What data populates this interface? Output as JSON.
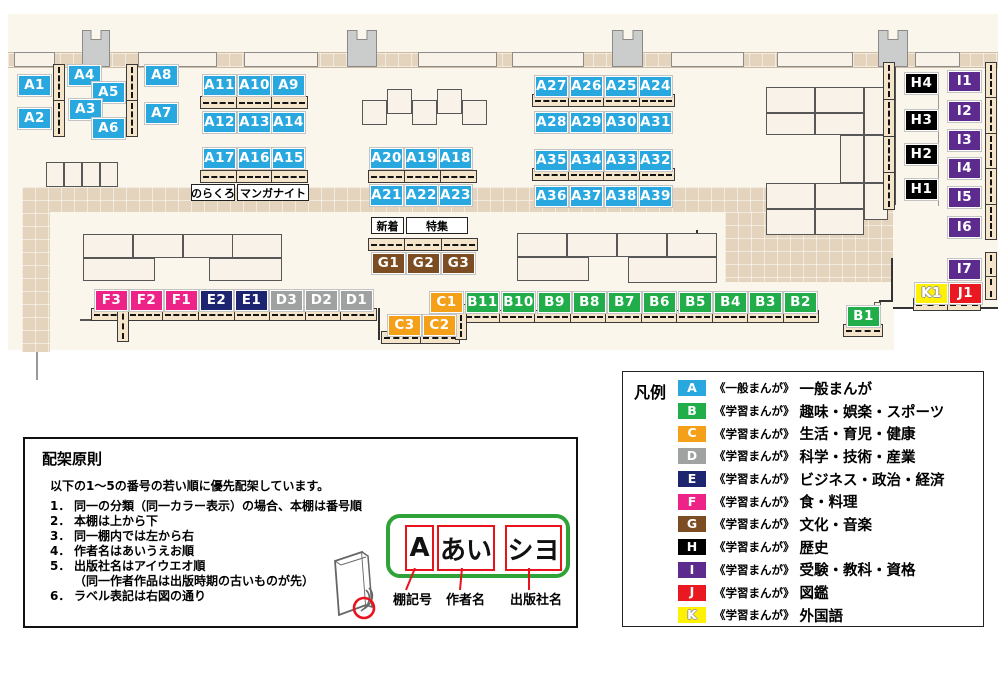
{
  "map": {
    "colors": {
      "A": "#29A8E0",
      "B": "#22AD4B",
      "C": "#F5A019",
      "D": "#A0A1A1",
      "E": "#1D2470",
      "F": "#EE2387",
      "G": "#7C4D22",
      "H": "#000000",
      "I": "#5C2B8D",
      "J": "#EA1821",
      "K": "#FFF101"
    },
    "labels": [
      {
        "id": "A1",
        "x": 18,
        "y": 75
      },
      {
        "id": "A2",
        "x": 18,
        "y": 108
      },
      {
        "id": "A4",
        "x": 68,
        "y": 65
      },
      {
        "id": "A5",
        "x": 92,
        "y": 82
      },
      {
        "id": "A3",
        "x": 69,
        "y": 99
      },
      {
        "id": "A6",
        "x": 92,
        "y": 118
      },
      {
        "id": "A8",
        "x": 145,
        "y": 65
      },
      {
        "id": "A7",
        "x": 145,
        "y": 103
      },
      {
        "id": "A11",
        "x": 203,
        "y": 75
      },
      {
        "id": "A10",
        "x": 238,
        "y": 75
      },
      {
        "id": "A9",
        "x": 272,
        "y": 75
      },
      {
        "id": "A12",
        "x": 203,
        "y": 112
      },
      {
        "id": "A13",
        "x": 238,
        "y": 112
      },
      {
        "id": "A14",
        "x": 272,
        "y": 112
      },
      {
        "id": "A17",
        "x": 203,
        "y": 148
      },
      {
        "id": "A16",
        "x": 238,
        "y": 148
      },
      {
        "id": "A15",
        "x": 272,
        "y": 148
      },
      {
        "id": "A20",
        "x": 370,
        "y": 148
      },
      {
        "id": "A19",
        "x": 405,
        "y": 148
      },
      {
        "id": "A18",
        "x": 439,
        "y": 148
      },
      {
        "id": "A21",
        "x": 370,
        "y": 185
      },
      {
        "id": "A22",
        "x": 405,
        "y": 185
      },
      {
        "id": "A23",
        "x": 439,
        "y": 185
      },
      {
        "id": "A27",
        "x": 535,
        "y": 76
      },
      {
        "id": "A26",
        "x": 570,
        "y": 76
      },
      {
        "id": "A25",
        "x": 605,
        "y": 76
      },
      {
        "id": "A24",
        "x": 639,
        "y": 76
      },
      {
        "id": "A28",
        "x": 535,
        "y": 112
      },
      {
        "id": "A29",
        "x": 570,
        "y": 112
      },
      {
        "id": "A30",
        "x": 605,
        "y": 112
      },
      {
        "id": "A31",
        "x": 639,
        "y": 112
      },
      {
        "id": "A35",
        "x": 535,
        "y": 150
      },
      {
        "id": "A34",
        "x": 570,
        "y": 150
      },
      {
        "id": "A33",
        "x": 605,
        "y": 150
      },
      {
        "id": "A32",
        "x": 639,
        "y": 150
      },
      {
        "id": "A36",
        "x": 535,
        "y": 186
      },
      {
        "id": "A37",
        "x": 570,
        "y": 186
      },
      {
        "id": "A38",
        "x": 605,
        "y": 186
      },
      {
        "id": "A39",
        "x": 639,
        "y": 186
      },
      {
        "id": "G1",
        "x": 372,
        "y": 253
      },
      {
        "id": "G2",
        "x": 407,
        "y": 253
      },
      {
        "id": "G3",
        "x": 442,
        "y": 253
      },
      {
        "id": "F3",
        "x": 95,
        "y": 290
      },
      {
        "id": "F2",
        "x": 130,
        "y": 290
      },
      {
        "id": "F1",
        "x": 165,
        "y": 290
      },
      {
        "id": "E2",
        "x": 200,
        "y": 290
      },
      {
        "id": "E1",
        "x": 235,
        "y": 290
      },
      {
        "id": "D3",
        "x": 270,
        "y": 290
      },
      {
        "id": "D2",
        "x": 305,
        "y": 290
      },
      {
        "id": "D1",
        "x": 340,
        "y": 290
      },
      {
        "id": "C1",
        "x": 430,
        "y": 292
      },
      {
        "id": "C3",
        "x": 388,
        "y": 315
      },
      {
        "id": "C2",
        "x": 423,
        "y": 315
      },
      {
        "id": "B11",
        "x": 466,
        "y": 292
      },
      {
        "id": "B10",
        "x": 502,
        "y": 292
      },
      {
        "id": "B9",
        "x": 538,
        "y": 292
      },
      {
        "id": "B8",
        "x": 573,
        "y": 292
      },
      {
        "id": "B7",
        "x": 608,
        "y": 292
      },
      {
        "id": "B6",
        "x": 643,
        "y": 292
      },
      {
        "id": "B5",
        "x": 679,
        "y": 292
      },
      {
        "id": "B4",
        "x": 714,
        "y": 292
      },
      {
        "id": "B3",
        "x": 749,
        "y": 292
      },
      {
        "id": "B2",
        "x": 784,
        "y": 292
      },
      {
        "id": "B1",
        "x": 847,
        "y": 306
      },
      {
        "id": "H4",
        "x": 905,
        "y": 73
      },
      {
        "id": "H3",
        "x": 905,
        "y": 110
      },
      {
        "id": "H2",
        "x": 905,
        "y": 144
      },
      {
        "id": "H1",
        "x": 905,
        "y": 179
      },
      {
        "id": "I1",
        "x": 948,
        "y": 71
      },
      {
        "id": "I2",
        "x": 948,
        "y": 101
      },
      {
        "id": "I3",
        "x": 948,
        "y": 130
      },
      {
        "id": "I4",
        "x": 948,
        "y": 158
      },
      {
        "id": "I5",
        "x": 948,
        "y": 187
      },
      {
        "id": "I6",
        "x": 948,
        "y": 217
      },
      {
        "id": "I7",
        "x": 948,
        "y": 259
      },
      {
        "id": "K1",
        "x": 915,
        "y": 283
      },
      {
        "id": "J1",
        "x": 949,
        "y": 283
      }
    ],
    "notes": [
      {
        "text": "のらくろ",
        "x": 191,
        "y": 184,
        "w": 44
      },
      {
        "text": "マンガナイト",
        "x": 237,
        "y": 184,
        "w": 72
      },
      {
        "text": "新着",
        "x": 371,
        "y": 217,
        "w": 33
      },
      {
        "text": "特集",
        "x": 406,
        "y": 217,
        "w": 62
      }
    ]
  },
  "legend": {
    "title": "凡例",
    "items": [
      {
        "key": "A",
        "series": "《一般まんが》",
        "category": "一般まんが"
      },
      {
        "key": "B",
        "series": "《学習まんが》",
        "category": "趣味・娯楽・スポーツ"
      },
      {
        "key": "C",
        "series": "《学習まんが》",
        "category": "生活・育児・健康"
      },
      {
        "key": "D",
        "series": "《学習まんが》",
        "category": "科学・技術・産業"
      },
      {
        "key": "E",
        "series": "《学習まんが》",
        "category": "ビジネス・政治・経済"
      },
      {
        "key": "F",
        "series": "《学習まんが》",
        "category": "食・料理"
      },
      {
        "key": "G",
        "series": "《学習まんが》",
        "category": "文化・音楽"
      },
      {
        "key": "H",
        "series": "《学習まんが》",
        "category": "歴史"
      },
      {
        "key": "I",
        "series": "《学習まんが》",
        "category": "受験・教科・資格"
      },
      {
        "key": "J",
        "series": "《学習まんが》",
        "category": "図鑑"
      },
      {
        "key": "K",
        "series": "《学習まんが》",
        "category": "外国語"
      }
    ]
  },
  "principles": {
    "title": "配架原則",
    "intro": "以下の1～5の番号の若い順に優先配架しています。",
    "items": [
      {
        "num": "1．",
        "text": "同一の分類（同一カラー表示）の場合、本棚は番号順"
      },
      {
        "num": "2．",
        "text": "本棚は上から下"
      },
      {
        "num": "3．",
        "text": "同一棚内では左から右"
      },
      {
        "num": "4．",
        "text": "作者名はあいうえお順"
      },
      {
        "num": "5．",
        "text": "出版社名はアイウエオ順",
        "note": "（同一作者作品は出版時期の古いものが先）"
      },
      {
        "num": "6．",
        "text": "ラベル表記は右図の通り"
      }
    ],
    "label_sample": {
      "boxes": [
        {
          "text": "A",
          "caption": "棚記号"
        },
        {
          "text": "あい",
          "caption": "作者名"
        },
        {
          "text": "シヨ",
          "caption": "出版社名"
        }
      ]
    }
  }
}
